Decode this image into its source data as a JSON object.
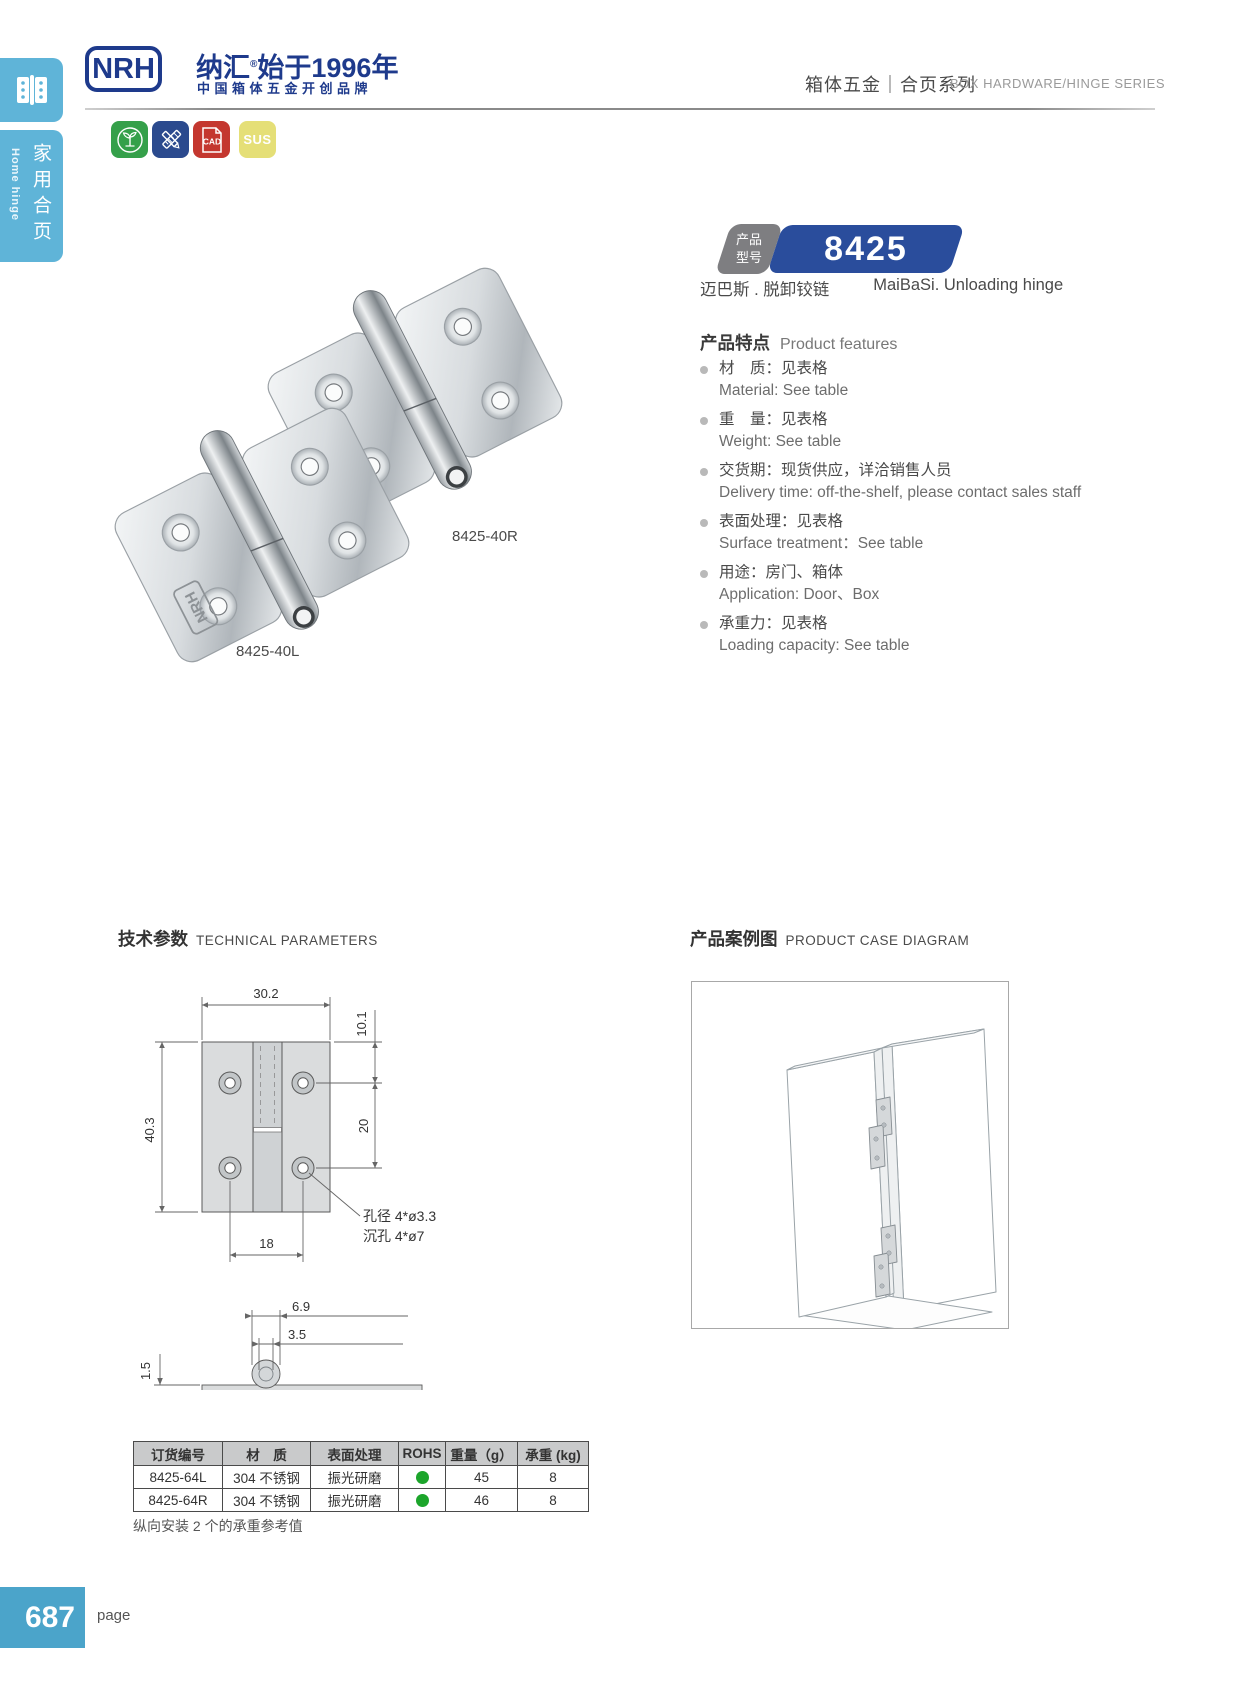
{
  "sidebar": {
    "category_zh": "家用合页",
    "category_en": "Home hinge",
    "icon": "hinge-icon"
  },
  "header": {
    "logo_text": "NRH",
    "brand_zh": "纳汇",
    "brand_reg": "®",
    "brand_since": "始于1996年",
    "brand_sub": "中国箱体五金开创品牌",
    "series_zh": "箱体五金｜合页系列",
    "series_en": "BOX HARDWARE/HINGE SERIES"
  },
  "cert_icons": {
    "eco": "eco-icon",
    "tools": "design-tools-icon",
    "cad_label": "CAD",
    "sus_label": "SUS"
  },
  "product": {
    "model_label_line1": "产品",
    "model_label_line2": "型号",
    "model_number": "8425",
    "subtitle_zh": "迈巴斯 . 脱卸铰链",
    "subtitle_en": "MaiBaSi. Unloading hinge",
    "features_title_zh": "产品特点",
    "features_title_en": "Product features",
    "features": [
      {
        "zh": "材　质：见表格",
        "en": "Material: See table"
      },
      {
        "zh": "重　量：见表格",
        "en": "Weight: See table"
      },
      {
        "zh": "交货期：现货供应，详洽销售人员",
        "en": "Delivery time: off-the-shelf, please contact sales staff"
      },
      {
        "zh": "表面处理：见表格",
        "en": "Surface treatment：See table"
      },
      {
        "zh": "用途：房门、箱体",
        "en": "Application: Door、Box"
      },
      {
        "zh": "承重力：见表格",
        "en": "Loading capacity: See table"
      }
    ],
    "photo_label_top": "8425-40R",
    "photo_label_bottom": "8425-40L"
  },
  "tech": {
    "title_zh": "技术参数",
    "title_en": "TECHNICAL PARAMETERS",
    "dims": {
      "width": "30.2",
      "top_offset": "10.1",
      "height": "40.3",
      "hole_span_v": "20",
      "hole_span_h": "18",
      "hole_note1": "孔径 4*ø3.3",
      "hole_note2": "沉孔 4*ø7",
      "knuckle_w": "6.9",
      "pin_d": "3.5",
      "thickness": "1.5"
    }
  },
  "case": {
    "title_zh": "产品案例图",
    "title_en": "PRODUCT CASE DIAGRAM"
  },
  "table": {
    "headers": [
      "订货编号",
      "材　质",
      "表面处理",
      "ROHS",
      "重量（g）",
      "承重 (kg)"
    ],
    "rows": [
      {
        "order": "8425-64L",
        "material": "304 不锈钢",
        "surface": "振光研磨",
        "rohs": "pass",
        "weight": "45",
        "load": "8"
      },
      {
        "order": "8425-64R",
        "material": "304 不锈钢",
        "surface": "振光研磨",
        "rohs": "pass",
        "weight": "46",
        "load": "8"
      }
    ],
    "note": "纵向安装 2 个的承重参考值"
  },
  "footer": {
    "page_number": "687",
    "page_label": "page"
  },
  "colors": {
    "sidebar_blue": "#5fb4d8",
    "logo_blue": "#1e3a8c",
    "badge_blue": "#2a4d9c",
    "badge_gray": "#7e7e81",
    "icon_green": "#35a04a",
    "icon_blue": "#2b4a8e",
    "icon_red": "#c4372f",
    "icon_yellow": "#e5df77",
    "rohs_green": "#1ca52b",
    "footer_blue": "#4ba4ca"
  }
}
